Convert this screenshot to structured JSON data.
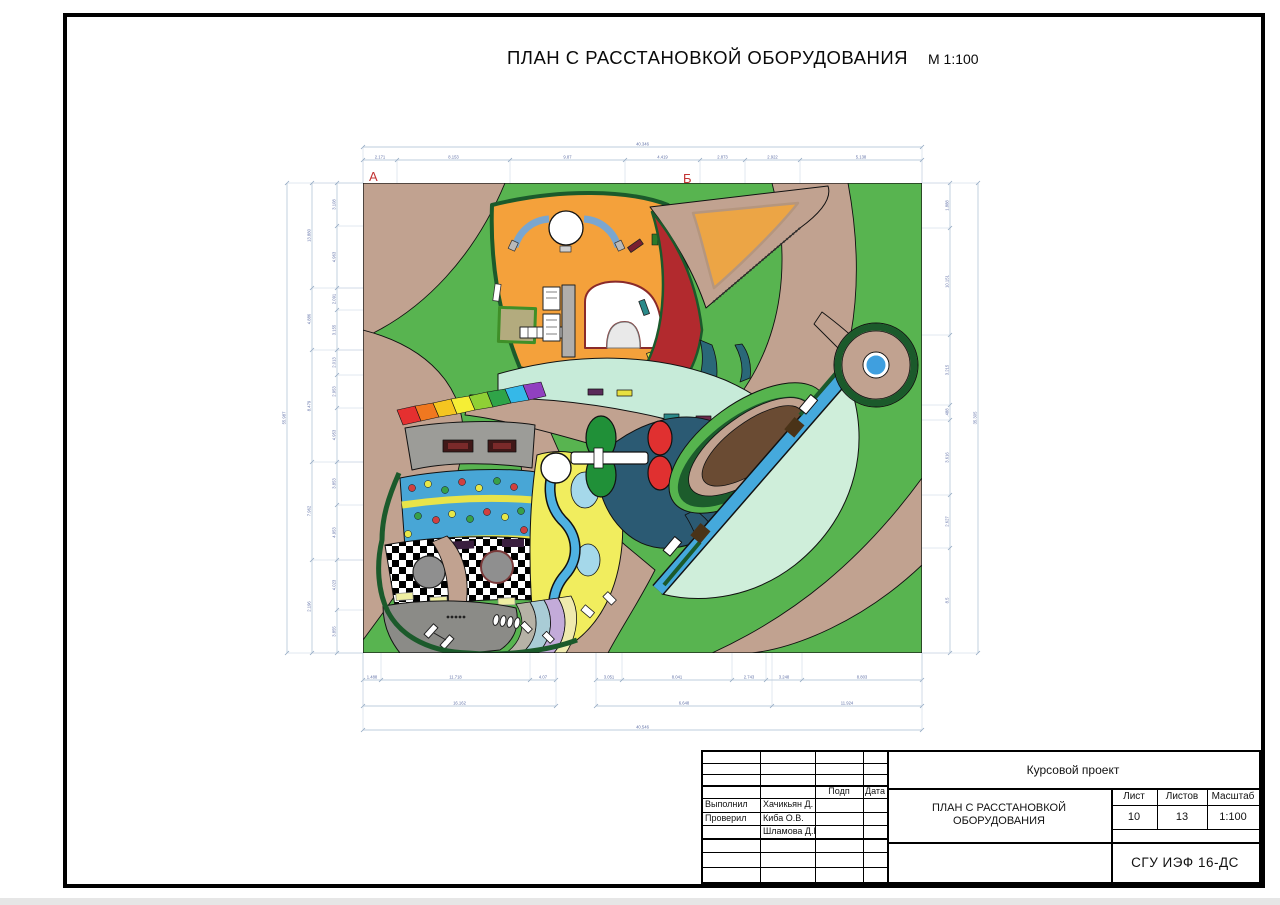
{
  "title": {
    "text": "ПЛАН С РАССТАНОВКОЙ ОБОРУДОВАНИЯ",
    "scale": "М 1:100"
  },
  "plan": {
    "axis_a": "А",
    "axis_b": "Б"
  },
  "colors": {
    "grass_green": "#58b450",
    "path_tan": "#c1a290",
    "dark_green_border": "#1b5a2b",
    "orange_zone": "#f4a13b",
    "red_crescent": "#b22a2e",
    "mint_band": "#c7ebd9",
    "slate_zone": "#2b5a73",
    "slide_blue": "#45a9dc",
    "slide_mint": "#cfeeda",
    "leaf_brown": "#6a4b33",
    "yellow_zone": "#f1ed5e",
    "river_blue": "#4fb2e2",
    "dotted_band_blue": "#48a6d6",
    "dim_line_blue": "#a9bcd2",
    "axis_letter_red": "#c23333"
  },
  "dim_chains": [
    {
      "name": "top-overall",
      "dir": "h",
      "pos": 147,
      "ticks": [
        363,
        922
      ],
      "labels": [
        "40.346"
      ]
    },
    {
      "name": "top-segments",
      "dir": "h",
      "pos": 160,
      "ticks": [
        363,
        397,
        510,
        625,
        700,
        745,
        800,
        922
      ],
      "labels": [
        "2.171",
        "8.153",
        "9.87",
        "4.419",
        "2.873",
        "2.922",
        "5.138"
      ]
    },
    {
      "name": "bottom-left-segments",
      "dir": "h",
      "pos": 680,
      "ticks": [
        363,
        381,
        530,
        556
      ],
      "labels": [
        "1.488",
        "11.718",
        "4.07"
      ]
    },
    {
      "name": "bottom-right-segments",
      "dir": "h",
      "pos": 680,
      "ticks": [
        596,
        622,
        732,
        766,
        802,
        922
      ],
      "labels": [
        "3.051",
        "8.041",
        "2.743",
        "3.248",
        "8.803"
      ]
    },
    {
      "name": "bottom-mid-left",
      "dir": "h",
      "pos": 706,
      "ticks": [
        363,
        556
      ],
      "labels": [
        "16.162"
      ]
    },
    {
      "name": "bottom-mid-right",
      "dir": "h",
      "pos": 706,
      "ticks": [
        596,
        772,
        922
      ],
      "labels": [
        "6.648",
        "11.924"
      ]
    },
    {
      "name": "bottom-overall",
      "dir": "h",
      "pos": 730,
      "ticks": [
        363,
        922
      ],
      "labels": [
        "40.546"
      ]
    },
    {
      "name": "left-overall",
      "dir": "v",
      "pos": 287,
      "ticks": [
        183,
        653
      ],
      "labels": [
        "55.987"
      ]
    },
    {
      "name": "left-majors",
      "dir": "v",
      "pos": 312,
      "ticks": [
        183,
        288,
        350,
        462,
        560,
        653
      ],
      "labels": [
        "13.880",
        "4.886",
        "8.479",
        "7.962",
        "2.196"
      ]
    },
    {
      "name": "left-minors",
      "dir": "v",
      "pos": 337,
      "ticks": [
        183,
        226,
        288,
        310,
        350,
        375,
        408,
        462,
        505,
        560,
        610,
        653
      ],
      "labels": [
        "3.108",
        "4.963",
        "2.091",
        "3.155",
        "2.013",
        "2.953",
        "4.953",
        "3.853",
        "4.953",
        "4.023",
        "3.855"
      ]
    },
    {
      "name": "right-segments",
      "dir": "v",
      "pos": 950,
      "ticks": [
        183,
        228,
        335,
        405,
        420,
        495,
        548,
        653
      ],
      "labels": [
        "1.888",
        "10.151",
        "3.215",
        ".488",
        "3.616",
        "2.627",
        "8.5"
      ]
    },
    {
      "name": "right-overall",
      "dir": "v",
      "pos": 978,
      "ticks": [
        183,
        653
      ],
      "labels": [
        "35.305"
      ]
    }
  ],
  "title_block": {
    "project_type": "Курсовой проект",
    "doc_title_line1": "ПЛАН С РАССТАНОВКОЙ",
    "doc_title_line2": "ОБОРУДОВАНИЯ",
    "sheet_label": "Лист",
    "sheets_label": "Листов",
    "scale_label": "Масштаб",
    "sheet_number": "10",
    "sheets_total": "13",
    "scale_value": "1:100",
    "sign_col_label": "Подп",
    "date_col_label": "Дата",
    "rows": [
      {
        "role": "Выполнил",
        "name": "Хачикьян Д."
      },
      {
        "role": "Проверил",
        "name": "Киба О.В."
      },
      {
        "role": "",
        "name": "Шламова Д.В."
      }
    ],
    "organization": "СГУ ИЭФ 16-ДС"
  }
}
